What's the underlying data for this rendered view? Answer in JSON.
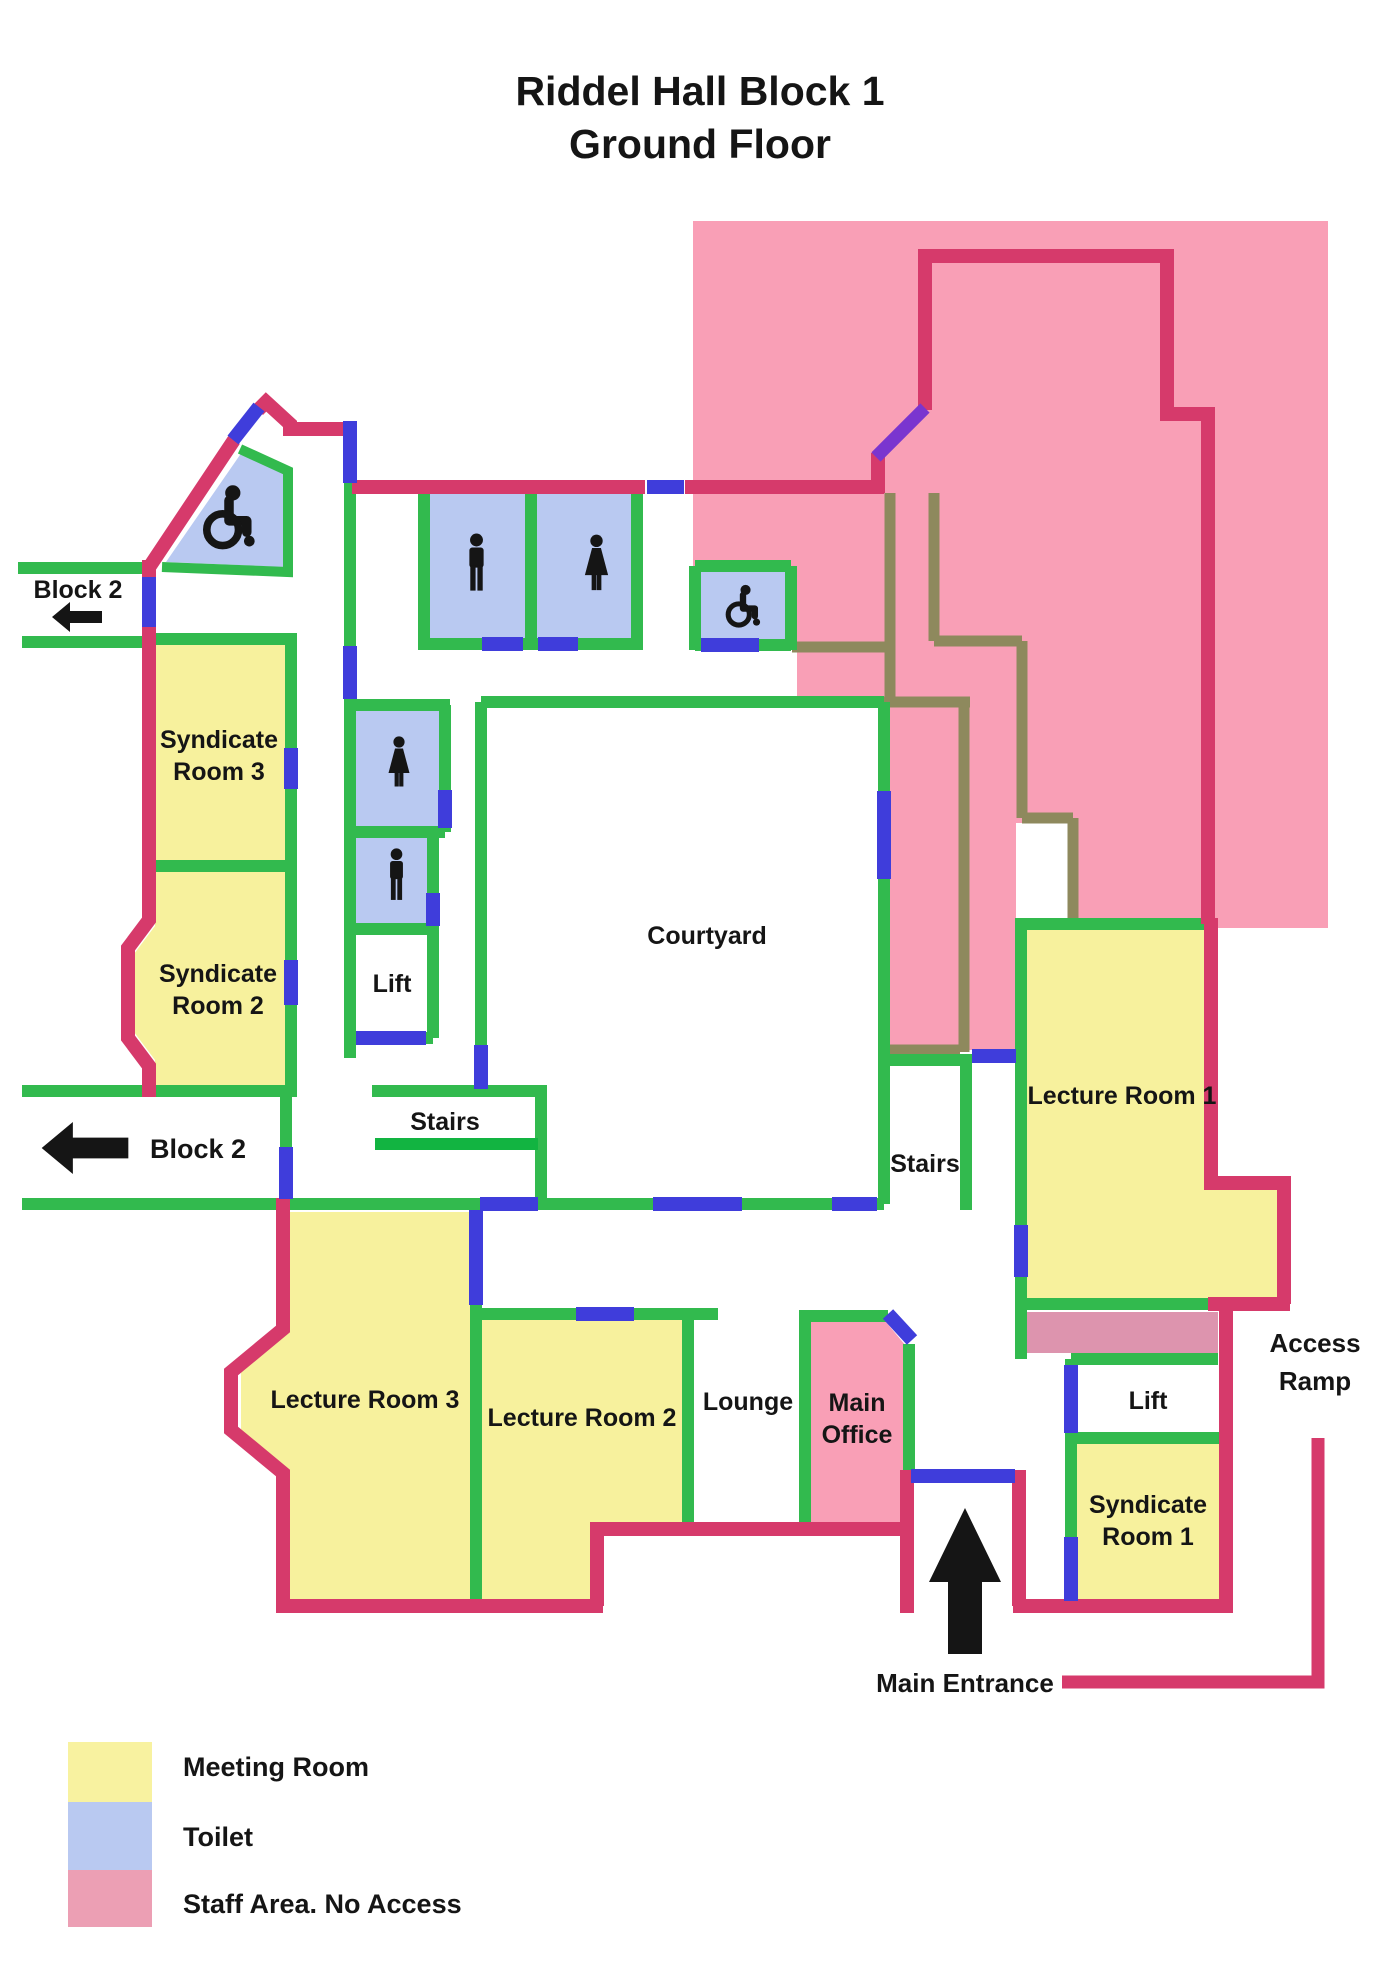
{
  "title": {
    "line1": "Riddel Hall Block 1",
    "line2": "Ground Floor"
  },
  "rooms": {
    "syndicate3_line1": "Syndicate",
    "syndicate3_line2": "Room 3",
    "syndicate2_line1": "Syndicate",
    "syndicate2_line2": "Room 2",
    "syndicate1_line1": "Syndicate",
    "syndicate1_line2": "Room 1",
    "lecture1": "Lecture Room 1",
    "lecture2": "Lecture Room 2",
    "lecture3": "Lecture Room 3",
    "courtyard": "Courtyard",
    "lounge": "Lounge",
    "office_line1": "Main",
    "office_line2": "Office",
    "lift_left": "Lift",
    "lift_right": "Lift",
    "stairs_left": "Stairs",
    "stairs_right": "Stairs"
  },
  "wayfinding": {
    "block2_top": "Block 2",
    "block2_bottom": "Block 2",
    "main_entrance": "Main Entrance",
    "access_ramp_line1": "Access",
    "access_ramp_line2": "Ramp"
  },
  "legend": {
    "items": [
      {
        "label": "Meeting Room",
        "color": "#f8f2a0"
      },
      {
        "label": "Toilet",
        "color": "#b9c9f1"
      },
      {
        "label": "Staff Area. No Access",
        "color": "#ec9fb4"
      }
    ]
  },
  "colors": {
    "wall_green": "#32ba4e",
    "wall_green_bright": "#12b441",
    "wall_crimson": "#d63a6b",
    "door_blue": "#3f3ddb",
    "door_purple": "#7a35cf",
    "wall_olive": "#8e895d",
    "staff_pink": "#f99fb6",
    "staff_strip_pink": "#dd94ae",
    "meeting_yellow": "#f7f19d",
    "toilet_blue": "#b9c9f1",
    "office_pink": "#f99fb6",
    "icon_black": "#151515"
  }
}
